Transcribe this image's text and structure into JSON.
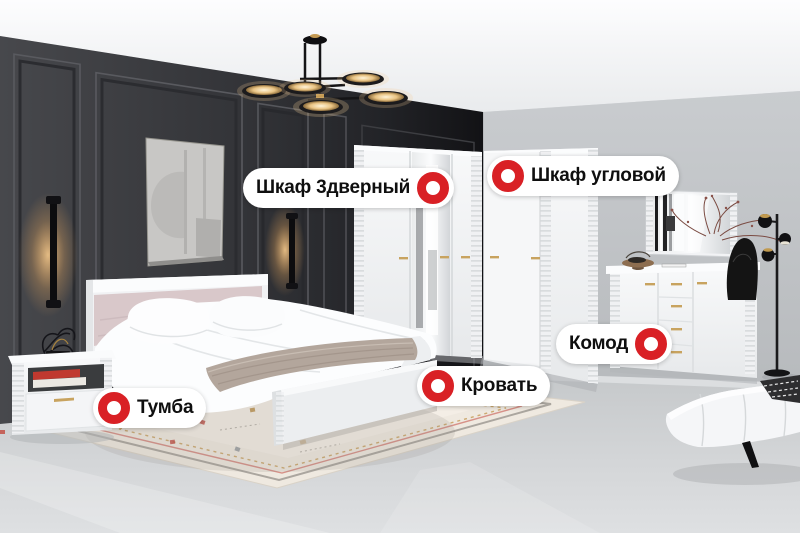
{
  "hotspots": [
    {
      "id": "wardrobe-3door",
      "label": "Шкаф 3дверный",
      "marker_position": "right"
    },
    {
      "id": "wardrobe-corner",
      "label": "Шкаф угловой",
      "marker_position": "left"
    },
    {
      "id": "dresser",
      "label": "Комод",
      "marker_position": "right"
    },
    {
      "id": "bed",
      "label": "Кровать",
      "marker_position": "left"
    },
    {
      "id": "nightstand",
      "label": "Тумба",
      "marker_position": "left"
    }
  ],
  "icons": {
    "hotspot_marker": "red-ring"
  },
  "colors": {
    "accent_red": "#D92025",
    "pill_background": "#FFFFFF",
    "pill_text": "#0F0F0F",
    "dark_wall": "#2F3033",
    "light_wall": "#C2C5C8",
    "floor": "#D6D8DA",
    "furniture_white": "#F2F3F5",
    "headboard_pink": "#D9C8CA",
    "gold_handle": "#C8A35F"
  }
}
